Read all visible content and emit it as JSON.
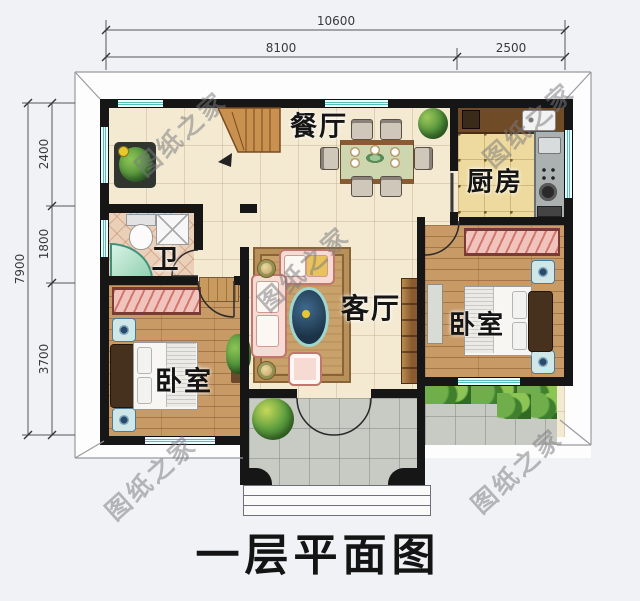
{
  "title": "一层平面图",
  "watermark_text": "图纸之家",
  "dimensions": {
    "top_total": "10600",
    "top_segments": [
      "8100",
      "2500"
    ],
    "left_total": "7900",
    "left_segments": [
      "2400",
      "1800",
      "3700"
    ]
  },
  "rooms": {
    "dining": "餐厅",
    "kitchen": "厨房",
    "bathroom": "卫",
    "living": "客厅",
    "bedroom_left": "卧室",
    "bedroom_right": "卧室"
  },
  "palette": {
    "wall": "#161616",
    "window_teal": "#56bcbc",
    "floor_cream": "#f4ead2",
    "floor_wood": "#c79a66",
    "floor_kitchen": "#eeda9e",
    "floor_bath": "#ead0b8",
    "floor_porch": "#c8cac4",
    "wardrobe_pink": "#f0c4bc",
    "stairs_wood": "#c9914f",
    "greenery": "#4e8f3a"
  }
}
